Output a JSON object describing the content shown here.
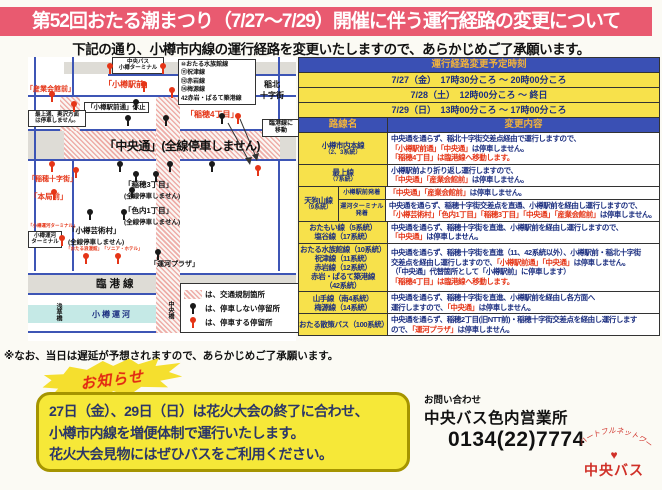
{
  "title": "第52回おたる潮まつり（7/27～7/29）開催に伴う運行経路の変更について",
  "subtitle": "下記の通り、小樽市内線の運行経路を変更いたしますので、あらかじめご了承願います。",
  "colors": {
    "title_bg": "#e95a70",
    "header_blue": "#3a50b4",
    "header_gold": "#f0b23c",
    "row_yellow": "#f7e14b",
    "navy": "#1c2f80",
    "red": "#e53517"
  },
  "map": {
    "terminal": [
      "中央バス",
      "小樽ターミナル"
    ],
    "route_list": [
      "⑩おたる水族館線",
      "⑪祝津線",
      "⑫赤岩線",
      "⑭梅源線",
      "42赤岩・ぱるて築港線"
    ],
    "hokko": [
      "稲北",
      "十字街"
    ],
    "sangyo": "「産業会館前」",
    "ekimae": "「小樽駅前」",
    "ekimae_kyushi": "「小樽駅前通」休止",
    "mogami": [
      "最上通、奥沢方面",
      "は停車しません。"
    ],
    "inaho4": "「稲穂4丁目」",
    "rinko_move": [
      "臨港線に",
      "移動"
    ],
    "chuo_dori": "「中央通」(全線停車しません)",
    "inaho_jujigai": "「稲穂十字街」",
    "honkyoku": "「本局前」",
    "inaho3": [
      "「稲穂3丁目」",
      "(全線停車しません)"
    ],
    "ironai1": [
      "「色内1丁目」",
      "(全線停車しません)"
    ],
    "geijutsu": [
      "「小樽芸術村」",
      "(全線停車しません)"
    ],
    "small_stop_1": "「おたる浪漫館」",
    "small_stop_2": "「ソニア・ホテル」",
    "unga_plaza": "「運河プラザ」",
    "unga_terminal_small": "「小樽運河ターミナル」",
    "unga_terminal_box": [
      "小樽運河",
      "ターミナル"
    ],
    "rinkosen": "臨港線",
    "otaru_unga": "小樽運河",
    "asakusabashi": "浅草橋",
    "chuobashi": "中央橋",
    "legend": [
      {
        "icon": "hatch",
        "text": "は、交通規制箇所"
      },
      {
        "icon": "black-stop",
        "text": "は、停車しない停留所"
      },
      {
        "icon": "red-stop",
        "text": "は、停車する停留所"
      }
    ],
    "stops": [
      {
        "x": 78,
        "y": 6,
        "t": "r"
      },
      {
        "x": 131,
        "y": 6,
        "t": "r"
      },
      {
        "x": 20,
        "y": 34,
        "t": "r"
      },
      {
        "x": 42,
        "y": 44,
        "t": "r"
      },
      {
        "x": 112,
        "y": 24,
        "t": "r"
      },
      {
        "x": 140,
        "y": 30,
        "t": "r"
      },
      {
        "x": 206,
        "y": 56,
        "t": "r"
      },
      {
        "x": 20,
        "y": 104,
        "t": "r"
      },
      {
        "x": 44,
        "y": 110,
        "t": "r"
      },
      {
        "x": 226,
        "y": 108,
        "t": "r"
      },
      {
        "x": 22,
        "y": 132,
        "t": "r"
      },
      {
        "x": 30,
        "y": 178,
        "t": "r"
      },
      {
        "x": 54,
        "y": 196,
        "t": "r"
      },
      {
        "x": 86,
        "y": 196,
        "t": "r"
      },
      {
        "x": 104,
        "y": 42,
        "t": "b"
      },
      {
        "x": 96,
        "y": 58,
        "t": "b"
      },
      {
        "x": 134,
        "y": 58,
        "t": "b"
      },
      {
        "x": 190,
        "y": 56,
        "t": "b"
      },
      {
        "x": 88,
        "y": 104,
        "t": "b"
      },
      {
        "x": 138,
        "y": 104,
        "t": "b"
      },
      {
        "x": 180,
        "y": 104,
        "t": "b"
      },
      {
        "x": 104,
        "y": 114,
        "t": "b"
      },
      {
        "x": 124,
        "y": 114,
        "t": "b"
      },
      {
        "x": 100,
        "y": 130,
        "t": "b"
      },
      {
        "x": 58,
        "y": 152,
        "t": "b"
      },
      {
        "x": 92,
        "y": 152,
        "t": "b"
      },
      {
        "x": 126,
        "y": 192,
        "t": "b"
      }
    ]
  },
  "schedule": {
    "header": "運行経路変更予定時刻",
    "rows": [
      "7/27（金）　17時30分ころ ～ 20時00分ころ",
      "7/28（土）　12時00分ころ ～ 終日",
      "7/29（日）　13時00分ころ ～ 17時00分ころ"
    ]
  },
  "table": {
    "header": {
      "route": "路線名",
      "change": "変更内容"
    },
    "routes": [
      {
        "name": [
          "小樽市内本線"
        ],
        "sub": "（2、3系統）",
        "lines": [
          [
            {
              "t": "中央通を通らず、稲北十字街交差点経由で運行しますので、",
              "c": "n"
            }
          ],
          [
            {
              "t": "「小樽駅前通」「中央通」",
              "c": "r"
            },
            {
              "t": "は停車しません。",
              "c": "n"
            }
          ],
          [
            {
              "t": "「稲穂4丁目」は臨港線へ移動します。",
              "c": "r"
            }
          ]
        ]
      },
      {
        "name": [
          "最上線"
        ],
        "sub": "（7系統）",
        "lines": [
          [
            {
              "t": "小樽駅前より折り返し運行しますので、",
              "c": "n"
            }
          ],
          [
            {
              "t": "「中央通」「産業会館前」",
              "c": "r"
            },
            {
              "t": "は停車しません。",
              "c": "n"
            }
          ]
        ]
      },
      {
        "name": [
          "天狗山線"
        ],
        "sub": "（9系統）",
        "subrows": [
          {
            "label": "小樽駅前発着",
            "lines": [
              [
                {
                  "t": "「中央通」「産業会館前」",
                  "c": "r"
                },
                {
                  "t": "は停車しません。",
                  "c": "n"
                }
              ]
            ]
          },
          {
            "label": "運河ターミナル発着",
            "lines": [
              [
                {
                  "t": "中央通を通らず、稲穂十字街交差点を直通、小樽駅前を経由し運行しますので、",
                  "c": "n"
                }
              ],
              [
                {
                  "t": "「小樽芸術村」「色内1丁目」「稲穂3丁目」「中央通」「産業会館前」",
                  "c": "r"
                },
                {
                  "t": "は停車しません。",
                  "c": "n"
                }
              ]
            ]
          }
        ]
      },
      {
        "name": [
          "おたもい線（5系統）",
          "塩谷線（17系統）"
        ],
        "sub": "",
        "lines": [
          [
            {
              "t": "中央通を通らず、稲穂十字街を直進、小樽駅前を経由し運行しますので、",
              "c": "n"
            }
          ],
          [
            {
              "t": "「中央通」",
              "c": "r"
            },
            {
              "t": "は停車しません。",
              "c": "n"
            }
          ]
        ]
      },
      {
        "name": [
          "おたる水族館線（10系統）",
          "祝津線（11系統）",
          "赤岩線（12系統）",
          "赤岩・ぱるて築港線",
          "（42系統）"
        ],
        "sub": "",
        "lines": [
          [
            {
              "t": "中央通を通らず、稲穂十字街を直進（11、42系統以外）、小樽駅前・稲北十字街",
              "c": "n"
            }
          ],
          [
            {
              "t": "交差点を経由し運行しますので、",
              "c": "n"
            },
            {
              "t": "「小樽駅前通」「中央通」",
              "c": "r"
            },
            {
              "t": "は停車しません。",
              "c": "n"
            }
          ],
          [
            {
              "t": "（「中央通」代替箇所として「小樽駅前」に停車します）",
              "c": "n"
            }
          ],
          [
            {
              "t": "「稲穂4丁目」は臨港線へ移動します。",
              "c": "r"
            }
          ]
        ]
      },
      {
        "name": [
          "山手線（南4系統）",
          "梅源線（14系統）"
        ],
        "sub": "",
        "lines": [
          [
            {
              "t": "中央通を通らず、稲穂十字街を直進、小樽駅前を経由し各方面へ",
              "c": "n"
            }
          ],
          [
            {
              "t": "運行しますので、",
              "c": "n"
            },
            {
              "t": "「中央通」",
              "c": "r"
            },
            {
              "t": "は停車しません。",
              "c": "n"
            }
          ]
        ]
      },
      {
        "name": [
          "おたる散策バス（100系統）"
        ],
        "sub": "",
        "lines": [
          [
            {
              "t": "中央通を通らず、稲穂2丁目(旧NTT前)・稲穂十字街交差点を経由し運行します",
              "c": "n"
            }
          ],
          [
            {
              "t": "ので、",
              "c": "n"
            },
            {
              "t": "「運河プラザ」",
              "c": "r"
            },
            {
              "t": "は停車しません。",
              "c": "n"
            }
          ]
        ]
      }
    ]
  },
  "note": "※なお、当日は遅延が予想されますので、あらかじめご了承願います。",
  "announcement": {
    "badge": "お知らせ",
    "lines": [
      "27日（金）、29日（日）は花火大会の終了に合わせ、",
      "小樽市内線を増便体制で運行いたします。",
      "花火大会見物にはぜひバスをご利用ください。"
    ]
  },
  "contact": {
    "label": "お問い合わせ",
    "office": "中央バス色内営業所",
    "phone": "0134(22)7774",
    "logo_arc": "ハートフルネットワーク",
    "logo_heart": "♥",
    "logo_text": "中央バス"
  }
}
